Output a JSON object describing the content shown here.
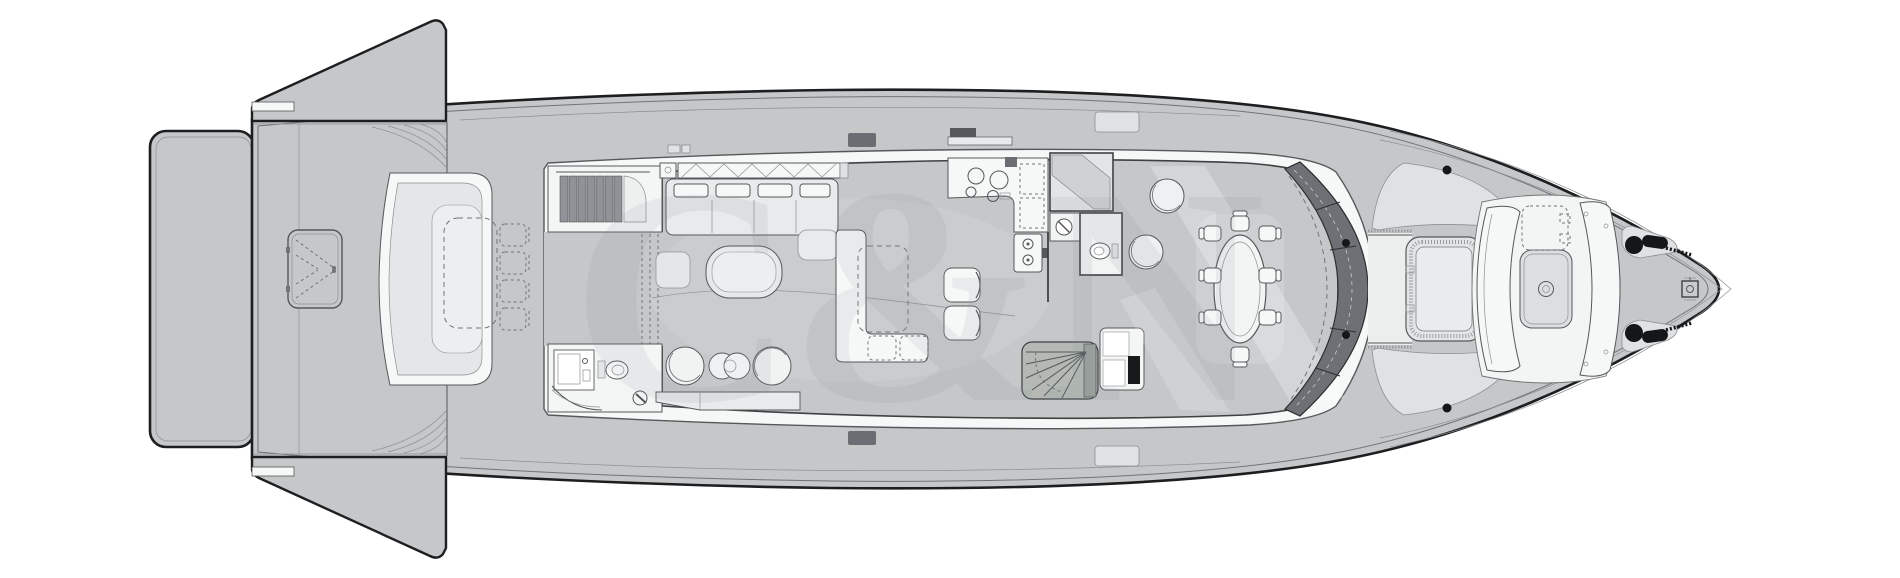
{
  "watermark": {
    "text": "C&N"
  },
  "palette": {
    "bg": "#ffffff",
    "deck": "#c5c7c9",
    "panel": "#dfe1e2",
    "cushion": "#e5e6e8",
    "white": "#f6f7f7",
    "outline": "#1c1e20",
    "wall": "#3e4144",
    "line": "#55585b",
    "lineMid": "#717477",
    "lineLight": "#8d9093",
    "windshield": "#6d7175",
    "tread": "#8f9398",
    "stairwell": "#b4b9b4",
    "black": "#141618",
    "wm": "#8b9197"
  }
}
